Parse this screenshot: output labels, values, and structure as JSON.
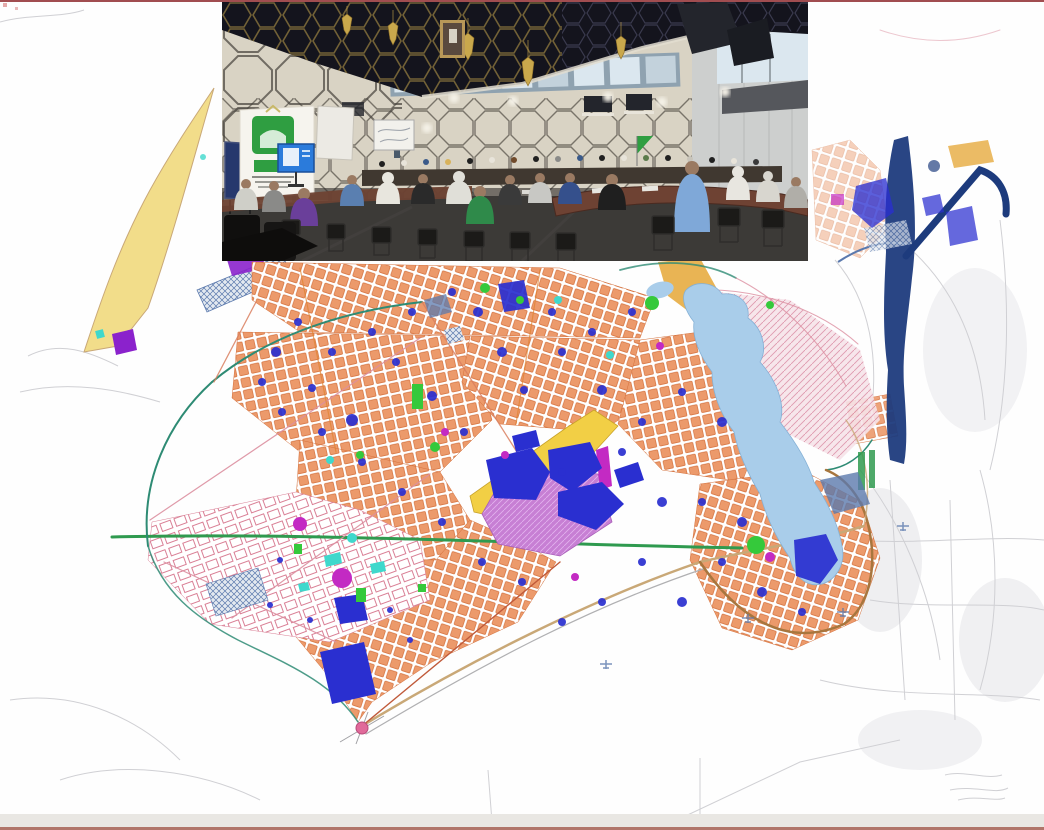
{
  "page": {
    "width": 1044,
    "height": 830,
    "description": "Urban development master plan map with inset photograph of a public deliberation meeting in a conference hall"
  },
  "photo_inset": {
    "alt": "conference-hall-meeting-photo",
    "left": 222,
    "top": 2,
    "width": 586,
    "height": 259
  },
  "palette": {
    "page": {
      "bg": "#fefefe",
      "top_rule": "#8a2024",
      "bottom_band": "#e9e7e3",
      "bottom_rule": "#b0756a"
    },
    "map": {
      "sketch": "#d0d0d4",
      "urban_fabric": "#ec9a6b",
      "urban_stroke": "#d4713d",
      "pink_block_stroke": "#d97f95",
      "road_green": "#2f9a4f",
      "road_teal": "#2e8b74",
      "road_tan": "#c9a877",
      "road_brown": "#a8763e",
      "road_rose": "#dc8fa0",
      "road_red": "#c05a3a",
      "road_orange": "#e0812f",
      "facility_blue": "#2a2fd0",
      "steel_blue": "#5b79ad",
      "water": "#a9cdea",
      "water_edge": "#85b1d6",
      "navy": "#1d3b7d",
      "yellow_pale": "#f2dd8a",
      "yellow_bright": "#f2cf45",
      "gold": "#e8b04b",
      "violet": "#c77fd4",
      "magenta": "#c32ac3",
      "green": "#35c93b",
      "cyan": "#3fd8cc",
      "purple": "#8b22cc",
      "hatch_blue": "#5b79ad",
      "hatch_pink": "#dc8fa6",
      "node_pink": "#e06a9a"
    },
    "photo": {
      "ceiling": "#14141d",
      "ceiling_hex": "#7d6a39",
      "chandelier": "#c9a84c",
      "wall": "#d9d3c4",
      "wall_line": "#45403a",
      "cornice": "#e2ddd0",
      "window_lit": "#dbe7ef",
      "window_dim": "#8fa2b0",
      "frame_dark": "#23252c",
      "right_wall": "#cdcfce",
      "soffit": "#55575c",
      "floor": "#3c3a37",
      "skirting": "#2e2c29",
      "table": "#6e4233",
      "chair": "#1b1a18",
      "banner_white": "#f6f4ee",
      "banner_green": "#2f9e41",
      "screen_blue": "#2b7bdb",
      "pinboard": "#26386d",
      "screen_white": "#eceae4",
      "skin": "#9a7a62"
    }
  }
}
